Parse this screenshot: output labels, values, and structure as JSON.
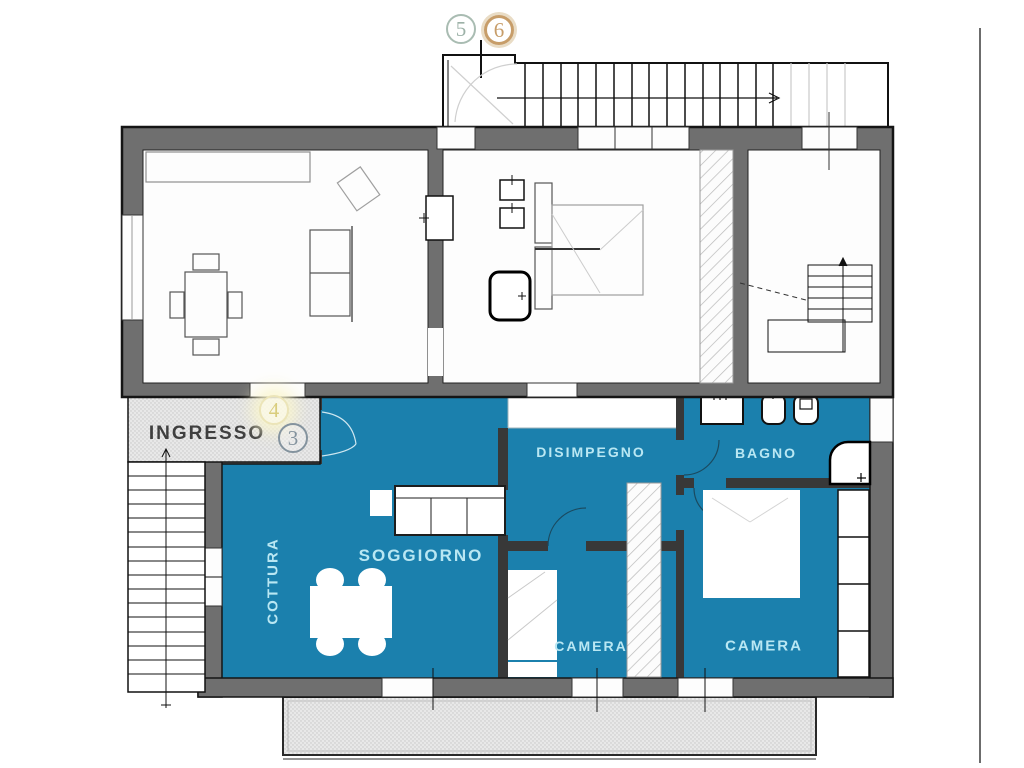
{
  "meta": {
    "type": "floor-plan",
    "language": "it",
    "description": "Two-level apartment floor plan; lower level highlighted in teal"
  },
  "rooms": [
    {
      "id": "ingresso",
      "name": "INGRESSO"
    },
    {
      "id": "disimpegno",
      "name": "DISIMPEGNO"
    },
    {
      "id": "bagno",
      "name": "BAGNO"
    },
    {
      "id": "soggiorno",
      "name": "SOGGIORNO"
    },
    {
      "id": "cottura",
      "name": "COTTURA"
    },
    {
      "id": "camera-1",
      "name": "CAMERA"
    },
    {
      "id": "camera-2",
      "name": "CAMERA"
    }
  ],
  "markers": [
    {
      "n": "5",
      "ring": "#a9bcb2"
    },
    {
      "n": "6",
      "ring": "#c79d69"
    },
    {
      "n": "4",
      "ring": "#e6dfad"
    },
    {
      "n": "3",
      "ring": "#84939e"
    }
  ],
  "colors": {
    "highlight": "#1b80ad",
    "wall": "#6f6f6f",
    "room_label_on_highlight": "#b9e7f3",
    "room_label_dark": "#3f3f3f",
    "paving": "#e8e8e8"
  }
}
